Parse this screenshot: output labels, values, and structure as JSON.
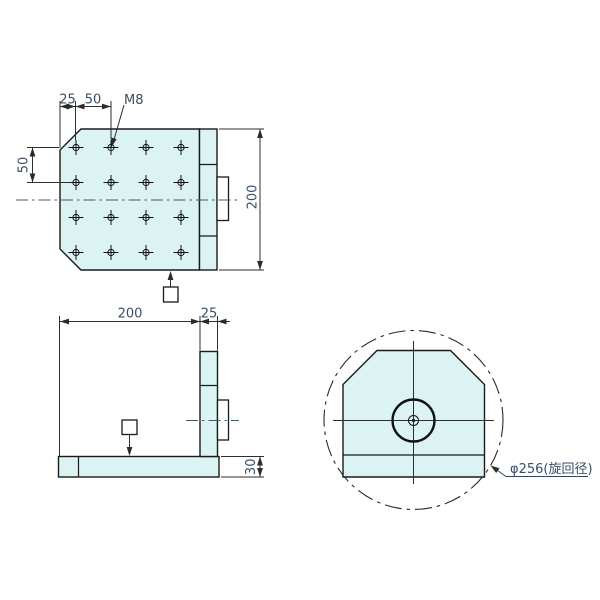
{
  "colors": {
    "plate_fill": "#dbf3f3",
    "outline": "#1a1a1a",
    "dimension_text": "#3a4e68"
  },
  "front_view": {
    "dim_edge_offset": "25",
    "dim_hole_pitch_h": "50",
    "thread_label": "M8",
    "dim_hole_pitch_v": "50",
    "dim_height": "200"
  },
  "side_view": {
    "dim_depth": "200",
    "dim_plate_thickness": "25",
    "dim_base_height": "30"
  },
  "rotated_view": {
    "swing_label": "φ256(旋回径)"
  }
}
